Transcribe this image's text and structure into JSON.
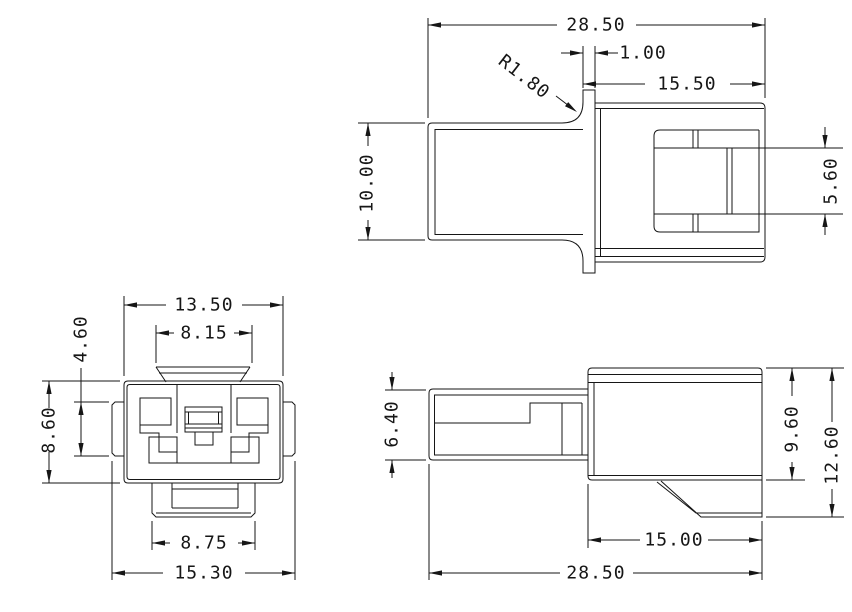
{
  "drawing": {
    "background_color": "#ffffff",
    "line_color": "#161616",
    "views": {
      "top_side_view": {
        "label": "side-view-upper",
        "dims": {
          "overall_width": "28.50",
          "flange_thickness": "1.00",
          "housing_length": "15.50",
          "fillet_radius": "R1.80",
          "barrel_height": "10.00",
          "latch_window_height": "5.60"
        }
      },
      "front_view": {
        "label": "front-view",
        "dims": {
          "body_width": "13.50",
          "tab_width": "8.15",
          "wing_height": "4.60",
          "body_height": "8.60",
          "skirt_width": "8.75",
          "overall_width": "15.30"
        }
      },
      "bottom_side_view": {
        "label": "side-view-lower",
        "dims": {
          "barrel_height": "6.40",
          "housing_height": "9.60",
          "overall_height": "12.60",
          "housing_length": "15.00",
          "overall_length": "28.50"
        }
      }
    }
  }
}
